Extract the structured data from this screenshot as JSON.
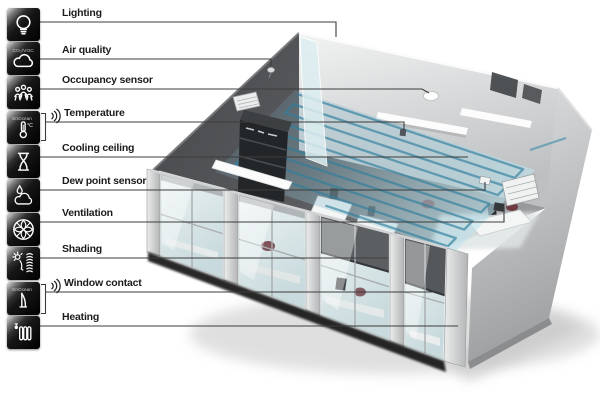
{
  "title": "Room automation functions infographic",
  "legend": {
    "items": [
      {
        "id": "lighting",
        "label": "Lighting",
        "icon": "light-bulb-icon"
      },
      {
        "id": "air-quality",
        "label": "Air quality",
        "icon": "cloud-icon",
        "icon_text": "CO₂/VOC"
      },
      {
        "id": "occupancy-sensor",
        "label": "Occupancy sensor",
        "icon": "people-icon"
      },
      {
        "id": "temperature",
        "label": "Temperature",
        "icon": "thermometer-icon",
        "icon_text": "EnOcean",
        "icon_unit": "°C",
        "wireless": true
      },
      {
        "id": "cooling-ceiling",
        "label": "Cooling ceiling",
        "icon": "hourglass-icon"
      },
      {
        "id": "dew-point-sensor",
        "label": "Dew point sensor",
        "icon": "droplet-cloud-icon"
      },
      {
        "id": "ventilation",
        "label": "Ventilation",
        "icon": "fan-icon"
      },
      {
        "id": "shading",
        "label": "Shading",
        "icon": "sun-blind-icon"
      },
      {
        "id": "window-contact",
        "label": "Window contact",
        "icon": "window-ajar-icon",
        "icon_text": "EnOcean",
        "wireless": true
      },
      {
        "id": "heating",
        "label": "Heating",
        "icon": "radiator-icon"
      }
    ]
  },
  "room": {
    "features": [
      "ceiling-cooling-coil",
      "ceiling-vent-grille",
      "air-quality-sensor",
      "occupancy-sensor",
      "wall-temperature-sensor",
      "dew-point-device",
      "ventilation-grille",
      "window-facade",
      "roller-shades",
      "interior-desks",
      "shelving",
      "pendant-lights",
      "glass-partition"
    ]
  },
  "colors": {
    "background": "#ffffff",
    "icon_tile": "#0d0d0d",
    "icon_glyph": "#ffffff",
    "connector_line": "#3c3c3c",
    "ceiling_dark": "#4a4b4e",
    "wall_light": "#e8e9ea",
    "coil_teal": "#2e7f9e",
    "glass": "#dfe9ec",
    "shade_gray": "#55585b",
    "chair_maroon": "#6e3a42"
  }
}
